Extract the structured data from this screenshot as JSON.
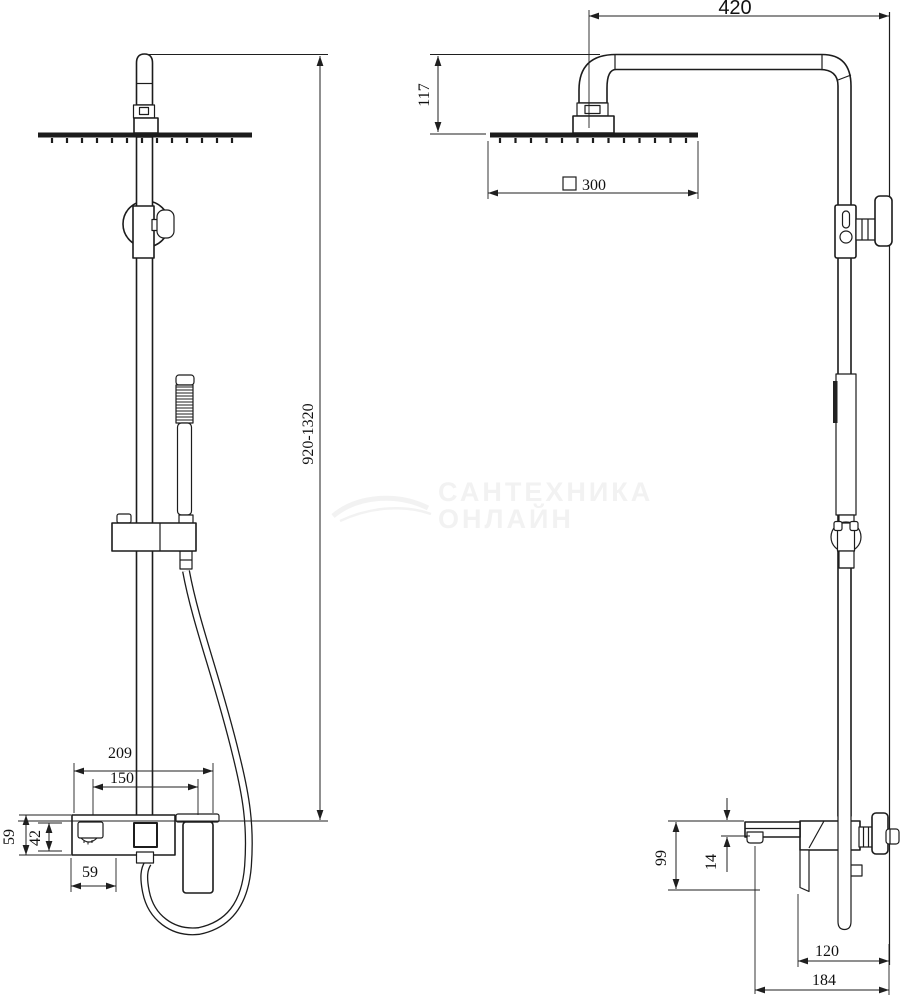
{
  "app": {
    "background": "#ffffff",
    "line_color": "#1c1c1c"
  },
  "watermark": {
    "line1": "САНТЕХНИКА",
    "line2": "ОНЛАЙН",
    "color": "#f2f2f2"
  },
  "views": {
    "front": {
      "dims": {
        "height_range": "920-1320",
        "mixer_width": "209",
        "mounting_centers": "150",
        "mixer_height": "59",
        "spout_body_height": "42",
        "spout_section_width": "59"
      }
    },
    "side": {
      "dims": {
        "arm_reach": "420",
        "arm_drop": "117",
        "head_size": "300",
        "spout_drop": "99",
        "spout_lip": "14",
        "handle_depth": "120",
        "total_depth": "184"
      }
    }
  }
}
